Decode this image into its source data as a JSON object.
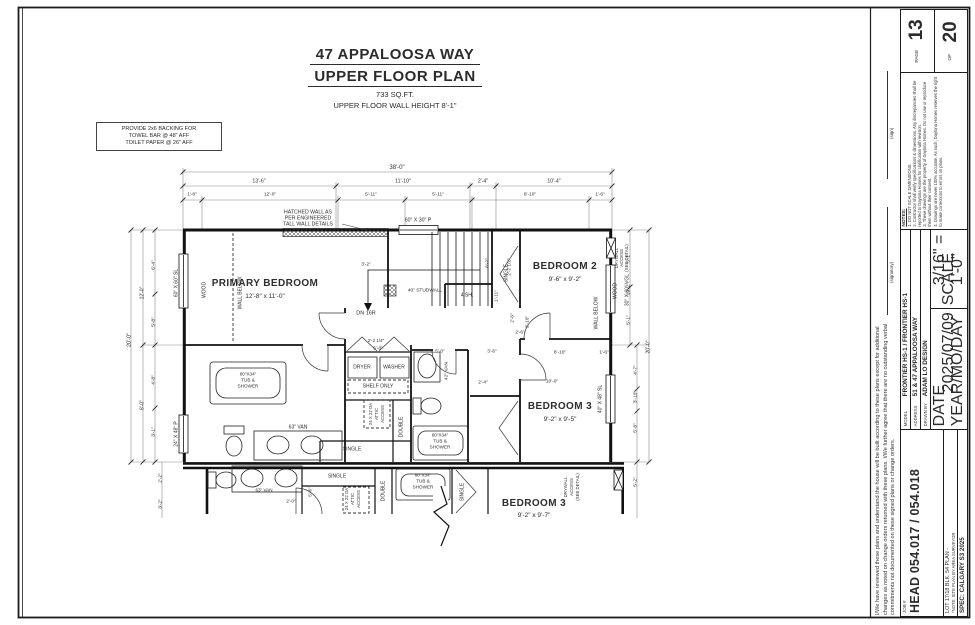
{
  "title": {
    "line1": "47 APPALOOSA WAY",
    "line2": "UPPER FLOOR PLAN",
    "line3": "733 SQ.FT.",
    "line4": "UPPER FLOOR WALL HEIGHT 8'-1\""
  },
  "note_box": {
    "l1": "PROVIDE 2x6 BACKING FOR",
    "l2": "TOWEL BAR @ 48\" AFF",
    "l3": "TOILET PAPER @ 26\" AFF"
  },
  "sheet": {
    "disclaimer": "I/We have reviewed these plans and understand the house will be built according to these plans except for additional changes as noted on change orders returned with these plans. I/We further agree that there are no outstanding verbal commitments not documented on these signed plans or change orders.",
    "signatory_label": "(signatory)",
    "sign_label": "(sign)",
    "job_label": "JOB #",
    "job_value": "HEAD 054.017 / 054.018",
    "lot_line": "LOT 17/18   BLK. 54   PLAN -",
    "lot_note": "*NOTE: SITE PLAN BY AREA SURVEYOR",
    "spec_line": "SPEC: CALGARY S3 2025",
    "model_label": "MODEL",
    "model_value": "FRONTIER HS-1 / FRONTIER HS-1",
    "address_label": "ADDRESS",
    "address_value": "51 & 47 APPALOOSA WAY",
    "drawn_by_label": "DRAWN BY",
    "drawn_by_value": "ADAM LO DESIGN",
    "date_label": "DATE",
    "date_sub": "YEAR/MO/DAY",
    "date_value": "2025/07/09",
    "scale_label": "SCALE",
    "scale_value": "3/16\" = 1'-0\"",
    "notes_title": "NOTES:",
    "notes": [
      "1. DO NOT SCALE DIMENSIONS.",
      "2. Contractor shall verify specifications & dimensions. Any discrepancies shall be reported to Daytona Homes for clarification with revision.",
      "3. These drawings are the property of Daytona Homes. Do not use or reproduce them without their consent.",
      "4. Drawings are never 100% accurate. As such, Daytona Homes reserves the right to make corrections to errors on plans."
    ],
    "page_label": "PAGE",
    "page_number": "13",
    "of_label": "OF",
    "total_pages": "20"
  },
  "plan": {
    "annotations": [
      {
        "t": "PRIMARY BEDROOM",
        "x": 265,
        "y": 284,
        "s": 10,
        "b": 1,
        "n": "room-label-primary-bedroom"
      },
      {
        "t": "12'-8\" x 11'-0\"",
        "x": 265,
        "y": 297,
        "s": 6.5,
        "n": "room-dims-primary-bedroom"
      },
      {
        "t": "BEDROOM 2",
        "x": 565,
        "y": 267,
        "s": 10,
        "b": 1,
        "n": "room-label-bedroom-2"
      },
      {
        "t": "9'-6\" x 9'-2\"",
        "x": 565,
        "y": 280,
        "s": 6.5,
        "n": "room-dims-bedroom-2"
      },
      {
        "t": "BEDROOM 3",
        "x": 560,
        "y": 407,
        "s": 10,
        "b": 1,
        "n": "room-label-bedroom-3"
      },
      {
        "t": "9'-2\" x 9'-5\"",
        "x": 560,
        "y": 420,
        "s": 6.5,
        "n": "room-dims-bedroom-3"
      },
      {
        "t": "BEDROOM 3",
        "x": 534,
        "y": 504,
        "s": 10,
        "b": 1,
        "n": "room-label-bedroom-3-lower"
      },
      {
        "t": "9'-2\" x 9'-7\"",
        "x": 534,
        "y": 516,
        "s": 6.5,
        "n": "room-dims-bedroom-3-lower"
      },
      {
        "t": "HATCHED WALL AS",
        "x": 308,
        "y": 213,
        "s": 5.2
      },
      {
        "t": "PER ENGINEERED",
        "x": 308,
        "y": 219,
        "s": 5.2
      },
      {
        "t": "TALL WALL DETAILS",
        "x": 308,
        "y": 225,
        "s": 5.2
      },
      {
        "t": "60\" X 30\" P",
        "x": 418,
        "y": 221,
        "s": 5.2
      },
      {
        "t": "60\" X 60\" SL",
        "x": 177,
        "y": 283,
        "r": -90,
        "s": 5
      },
      {
        "t": "24\" X 48\" P",
        "x": 177,
        "y": 434,
        "r": -90,
        "s": 5
      },
      {
        "t": "30\" X 60\" VGL",
        "x": 628,
        "y": 290,
        "r": -90,
        "s": 5
      },
      {
        "t": "40\" X 48\" SL",
        "x": 601,
        "y": 399,
        "r": -90,
        "s": 5
      },
      {
        "t": "WOOD",
        "x": 205,
        "y": 290,
        "r": -90,
        "s": 5
      },
      {
        "t": "WALL BELOW",
        "x": 241,
        "y": 293,
        "r": -90,
        "s": 5
      },
      {
        "t": "WOOD",
        "x": 616,
        "y": 291,
        "r": -90,
        "s": 5
      },
      {
        "t": "WALL BELOW",
        "x": 597,
        "y": 313,
        "r": -90,
        "s": 5
      },
      {
        "t": "DRYWALL",
        "x": 617,
        "y": 258,
        "r": -90,
        "s": 4.3
      },
      {
        "t": "ACCESS",
        "x": 622,
        "y": 258,
        "r": -90,
        "s": 4.3
      },
      {
        "t": "(SEE DETAIL)",
        "x": 627,
        "y": 258,
        "r": -90,
        "s": 4.3
      },
      {
        "t": "DN 16R",
        "x": 366,
        "y": 314,
        "s": 5.5
      },
      {
        "t": "40\" STUDWALL",
        "x": 425,
        "y": 292,
        "s": 4.8
      },
      {
        "t": "4 SH.",
        "x": 467,
        "y": 296,
        "s": 5
      },
      {
        "t": "SINGLE",
        "x": 507,
        "y": 273,
        "r": -90,
        "s": 5
      },
      {
        "t": "6'-2\"",
        "x": 489,
        "y": 263,
        "r": -90,
        "s": 4.8
      },
      {
        "t": "2'-2 1/2\"",
        "x": 511,
        "y": 267,
        "r": -90,
        "s": 4.8
      },
      {
        "t": "1'-11\"",
        "x": 498,
        "y": 296,
        "r": -90,
        "s": 4.8
      },
      {
        "t": "2'-6\"",
        "x": 514,
        "y": 318,
        "r": -90,
        "s": 4.8
      },
      {
        "t": "3'-10\"",
        "x": 529,
        "y": 322,
        "r": -90,
        "s": 4.8
      },
      {
        "t": "2'-6\"",
        "x": 520,
        "y": 334,
        "s": 4.8
      },
      {
        "t": "DRYER",
        "x": 362,
        "y": 368,
        "s": 5
      },
      {
        "t": "WASHER",
        "x": 394,
        "y": 368,
        "s": 5
      },
      {
        "t": "SHELF ONLY",
        "x": 378,
        "y": 387,
        "s": 5
      },
      {
        "t": "5'-8\"",
        "x": 378,
        "y": 350,
        "s": 4.8
      },
      {
        "t": "5'-0\"",
        "x": 440,
        "y": 353,
        "s": 4.8
      },
      {
        "t": "3'-6\"",
        "x": 492,
        "y": 353,
        "s": 4.8
      },
      {
        "t": "2'-4\"",
        "x": 483,
        "y": 384,
        "s": 4.8
      },
      {
        "t": "2'-2 1/4\"",
        "x": 376,
        "y": 341,
        "s": 4.5
      },
      {
        "t": "42\" VAN",
        "x": 448,
        "y": 371,
        "r": -90,
        "s": 4.8
      },
      {
        "t": "60\"X34\"",
        "x": 440,
        "y": 436,
        "s": 4.6
      },
      {
        "t": "TUB &",
        "x": 440,
        "y": 442,
        "s": 4.6
      },
      {
        "t": "SHOWER",
        "x": 440,
        "y": 448,
        "s": 4.6
      },
      {
        "t": "60\"X34\"",
        "x": 248,
        "y": 375,
        "s": 4.6
      },
      {
        "t": "TUB &",
        "x": 248,
        "y": 381,
        "s": 4.6
      },
      {
        "t": "SHOWER",
        "x": 248,
        "y": 387,
        "s": 4.6
      },
      {
        "t": "63\" VAN",
        "x": 298,
        "y": 428,
        "s": 5
      },
      {
        "t": "SINGLE",
        "x": 352,
        "y": 450,
        "s": 5
      },
      {
        "t": "DOUBLE",
        "x": 402,
        "y": 427,
        "r": -90,
        "s": 5
      },
      {
        "t": "24 X 22 OA",
        "x": 371,
        "y": 414,
        "r": -90,
        "s": 4.3
      },
      {
        "t": "ATTIC",
        "x": 377,
        "y": 414,
        "r": -90,
        "s": 4.3
      },
      {
        "t": "ACCESS",
        "x": 383,
        "y": 414,
        "r": -90,
        "s": 4.3
      },
      {
        "t": "10'-0\"",
        "x": 552,
        "y": 383,
        "s": 4.8
      },
      {
        "t": "8'-10\"",
        "x": 560,
        "y": 354,
        "s": 4.8
      },
      {
        "t": "1'-6\"",
        "x": 604,
        "y": 354,
        "s": 4.8
      },
      {
        "t": "3'-2\"",
        "x": 366,
        "y": 266,
        "s": 4.8
      },
      {
        "t": "63\" VAN",
        "x": 264,
        "y": 491,
        "s": 4.6
      },
      {
        "t": "SINGLE",
        "x": 337,
        "y": 477,
        "s": 5
      },
      {
        "t": "24 X 22 OA",
        "x": 347,
        "y": 499,
        "r": -90,
        "s": 4.3
      },
      {
        "t": "ATTIC",
        "x": 353,
        "y": 499,
        "r": -90,
        "s": 4.3
      },
      {
        "t": "ACCESS",
        "x": 359,
        "y": 499,
        "r": -90,
        "s": 4.3
      },
      {
        "t": "DOUBLE",
        "x": 384,
        "y": 491,
        "r": -90,
        "s": 5
      },
      {
        "t": "60\"X34\"",
        "x": 423,
        "y": 476,
        "s": 4.6
      },
      {
        "t": "TUB &",
        "x": 423,
        "y": 482,
        "s": 4.6
      },
      {
        "t": "SHOWER",
        "x": 423,
        "y": 488,
        "s": 4.6
      },
      {
        "t": "SINGLE",
        "x": 463,
        "y": 492,
        "r": -90,
        "s": 5
      },
      {
        "t": "DRYWALL",
        "x": 566,
        "y": 487,
        "r": -90,
        "s": 4.3
      },
      {
        "t": "ACCESS",
        "x": 572,
        "y": 487,
        "r": -90,
        "s": 4.3
      },
      {
        "t": "(SEE DETAIL)",
        "x": 578,
        "y": 487,
        "r": -90,
        "s": 4.3
      },
      {
        "t": "5'-6\"",
        "x": 312,
        "y": 492,
        "r": -90,
        "s": 4.8
      },
      {
        "t": "2'-0\"",
        "x": 291,
        "y": 503,
        "s": 4.8
      },
      {
        "t": "38'-0\"",
        "x": 397,
        "y": 168,
        "s": 6,
        "n": "dim-overall-width"
      },
      {
        "t": "13'-6\"",
        "x": 259,
        "y": 182,
        "s": 5.2
      },
      {
        "t": "11'-10\"",
        "x": 403,
        "y": 182,
        "s": 5.2
      },
      {
        "t": "2'-4\"",
        "x": 483,
        "y": 182,
        "s": 5.2
      },
      {
        "t": "10'-4\"",
        "x": 554,
        "y": 182,
        "s": 5.2
      },
      {
        "t": "1'-8\"",
        "x": 192,
        "y": 196,
        "s": 4.8
      },
      {
        "t": "12'-0\"",
        "x": 270,
        "y": 196,
        "s": 4.8
      },
      {
        "t": "5'-11\"",
        "x": 371,
        "y": 196,
        "s": 4.8
      },
      {
        "t": "5'-11\"",
        "x": 438,
        "y": 196,
        "s": 4.8
      },
      {
        "t": "8'-10\"",
        "x": 530,
        "y": 196,
        "s": 4.8
      },
      {
        "t": "1'-6\"",
        "x": 600,
        "y": 196,
        "s": 4.8
      },
      {
        "t": "20'-0\"",
        "x": 130,
        "y": 340,
        "r": -90,
        "s": 5.5,
        "n": "dim-overall-depth"
      },
      {
        "t": "12'-0\"",
        "x": 143,
        "y": 293,
        "r": -90,
        "s": 5
      },
      {
        "t": "8'-0\"",
        "x": 143,
        "y": 405,
        "r": -90,
        "s": 5
      },
      {
        "t": "6'-4\"",
        "x": 155,
        "y": 265,
        "r": -90,
        "s": 4.8
      },
      {
        "t": "5'-8\"",
        "x": 155,
        "y": 322,
        "r": -90,
        "s": 4.8
      },
      {
        "t": "4'-8\"",
        "x": 155,
        "y": 380,
        "r": -90,
        "s": 4.8
      },
      {
        "t": "3'-1\"",
        "x": 155,
        "y": 432,
        "r": -90,
        "s": 4.8
      },
      {
        "t": "2'-2\"",
        "x": 162,
        "y": 478,
        "r": -90,
        "s": 4.8
      },
      {
        "t": "3'-2\"",
        "x": 162,
        "y": 504,
        "r": -90,
        "s": 4.8
      },
      {
        "t": "5'-1\"",
        "x": 630,
        "y": 258,
        "r": -90,
        "s": 4.8
      },
      {
        "t": "10'-2\"",
        "x": 630,
        "y": 289,
        "r": -90,
        "s": 4.8
      },
      {
        "t": "5'-1\"",
        "x": 630,
        "y": 320,
        "r": -90,
        "s": 4.8
      },
      {
        "t": "4'-7\"",
        "x": 637,
        "y": 370,
        "r": -90,
        "s": 4.8
      },
      {
        "t": "3'-10\"",
        "x": 637,
        "y": 397,
        "r": -90,
        "s": 4.8
      },
      {
        "t": "5'-8\"",
        "x": 637,
        "y": 428,
        "r": -90,
        "s": 4.8
      },
      {
        "t": "20'-0\"",
        "x": 649,
        "y": 347,
        "r": -90,
        "s": 5.2
      },
      {
        "t": "5'-2\"",
        "x": 637,
        "y": 482,
        "r": -90,
        "s": 4.8
      }
    ]
  }
}
